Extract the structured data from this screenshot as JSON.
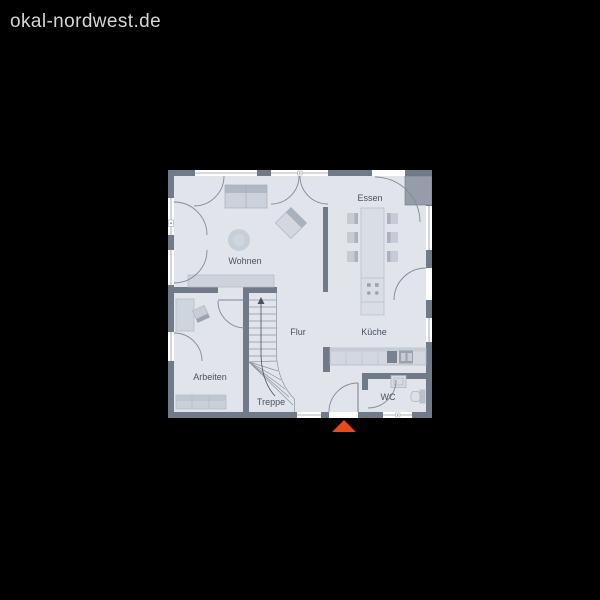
{
  "brand": {
    "domain": "okal-nordwest.de"
  },
  "floorplan": {
    "rooms": [
      {
        "id": "wohnen",
        "label": "Wohnen"
      },
      {
        "id": "essen",
        "label": "Essen"
      },
      {
        "id": "kueche",
        "label": "Küche"
      },
      {
        "id": "flur",
        "label": "Flur"
      },
      {
        "id": "arbeiten",
        "label": "Arbeiten"
      },
      {
        "id": "treppe",
        "label": "Treppe"
      },
      {
        "id": "wc",
        "label": "WC"
      }
    ],
    "colors": {
      "background": "#000000",
      "brand_text": "#d6d6d6",
      "wall": "#717a89",
      "floor": "#e1e4ea",
      "furniture": "#ccd2db",
      "window": "#ffffff",
      "label_text": "#4a5260",
      "accent": "#e8481c"
    },
    "marker": {
      "type": "entrance-triangle"
    }
  }
}
